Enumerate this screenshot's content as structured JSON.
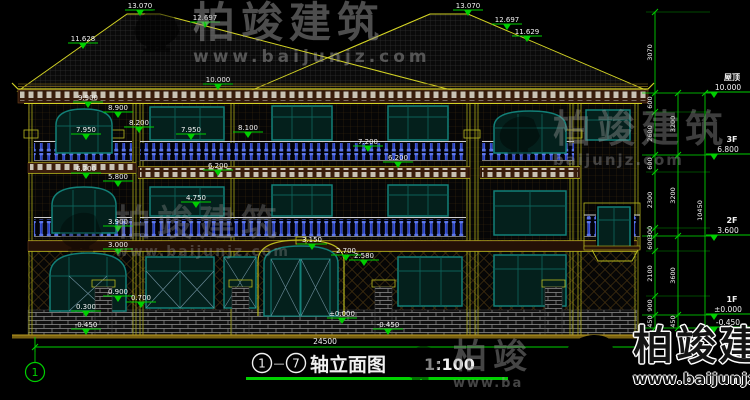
{
  "drawing": {
    "title": {
      "axis_from": "1",
      "axis_to": "7",
      "dash": "—",
      "name": "轴立面图",
      "scale": "1:100"
    },
    "axis_bubbles": [
      {
        "label": "1"
      }
    ],
    "overall_dim": "24500",
    "levels": [
      {
        "name": "屋顶",
        "value": "10.000",
        "y": 93
      },
      {
        "name": "3F",
        "value": "6.800",
        "y": 155
      },
      {
        "name": "2F",
        "value": "3.600",
        "y": 236
      },
      {
        "name": "1F",
        "value": "±0.000",
        "y": 315
      },
      {
        "name": "",
        "value": "-0.450",
        "y": 328
      }
    ],
    "elevation_markers": [
      {
        "text": "13.070",
        "x": 140,
        "y": 16
      },
      {
        "text": "12.697",
        "x": 205,
        "y": 28
      },
      {
        "text": "11.628",
        "x": 83,
        "y": 49
      },
      {
        "text": "13.070",
        "x": 468,
        "y": 16
      },
      {
        "text": "12.697",
        "x": 507,
        "y": 30
      },
      {
        "text": "11.629",
        "x": 527,
        "y": 42
      },
      {
        "text": "10.000",
        "x": 218,
        "y": 90
      },
      {
        "text": "9.900",
        "x": 88,
        "y": 108
      },
      {
        "text": "8.900",
        "x": 118,
        "y": 118
      },
      {
        "text": "8.200",
        "x": 139,
        "y": 133
      },
      {
        "text": "7.950",
        "x": 86,
        "y": 140
      },
      {
        "text": "7.950",
        "x": 191,
        "y": 140
      },
      {
        "text": "8.100",
        "x": 248,
        "y": 138
      },
      {
        "text": "7.200",
        "x": 368,
        "y": 152
      },
      {
        "text": "6.200",
        "x": 398,
        "y": 168
      },
      {
        "text": "6.200",
        "x": 86,
        "y": 179
      },
      {
        "text": "5.800",
        "x": 118,
        "y": 187
      },
      {
        "text": "6.200",
        "x": 218,
        "y": 176
      },
      {
        "text": "4.750",
        "x": 196,
        "y": 208
      },
      {
        "text": "3.900",
        "x": 118,
        "y": 232
      },
      {
        "text": "3.000",
        "x": 118,
        "y": 255
      },
      {
        "text": "3.150",
        "x": 312,
        "y": 250
      },
      {
        "text": "2.700",
        "x": 346,
        "y": 261
      },
      {
        "text": "2.580",
        "x": 364,
        "y": 266
      },
      {
        "text": "0.900",
        "x": 118,
        "y": 302
      },
      {
        "text": "0.700",
        "x": 141,
        "y": 308
      },
      {
        "text": "0.300",
        "x": 86,
        "y": 317
      },
      {
        "text": "±0.000",
        "x": 342,
        "y": 324
      },
      {
        "text": "-0.450",
        "x": 86,
        "y": 335
      },
      {
        "text": "-0.450",
        "x": 388,
        "y": 335
      }
    ],
    "dim_chains": [
      {
        "x": 655,
        "nodes": [
          12,
          93,
          112,
          155,
          172,
          228,
          236,
          251,
          296,
          315,
          328
        ],
        "values": [
          "3070",
          "600",
          "2600",
          "600",
          "2300",
          "300",
          "600",
          "2100",
          "900",
          "450"
        ]
      },
      {
        "x": 678,
        "nodes": [
          93,
          155,
          236,
          315,
          328
        ],
        "values": [
          "3200",
          "3200",
          "3600",
          "450"
        ]
      },
      {
        "x": 705,
        "nodes": [
          93,
          328
        ],
        "values": [
          "10450"
        ]
      }
    ]
  },
  "watermarks": {
    "brand": "柏竣建筑",
    "brand_partial": "柏竣",
    "url": "www.baijunjz.com",
    "url_short": "baijunjz.com",
    "url_partial": "www.ba"
  },
  "colors": {
    "background": "#000000",
    "dim_green": "#00cf00",
    "text_white": "#f2f2f2",
    "outline_yellow": "#c9c920",
    "frame_teal": "#128078",
    "baluster_blue": "#2740c8",
    "brick_mortar": "#8f8f8f",
    "eave_brown": "#2c150a",
    "logo_blue": "#1468c8",
    "logo_orange": "#f2a007"
  }
}
